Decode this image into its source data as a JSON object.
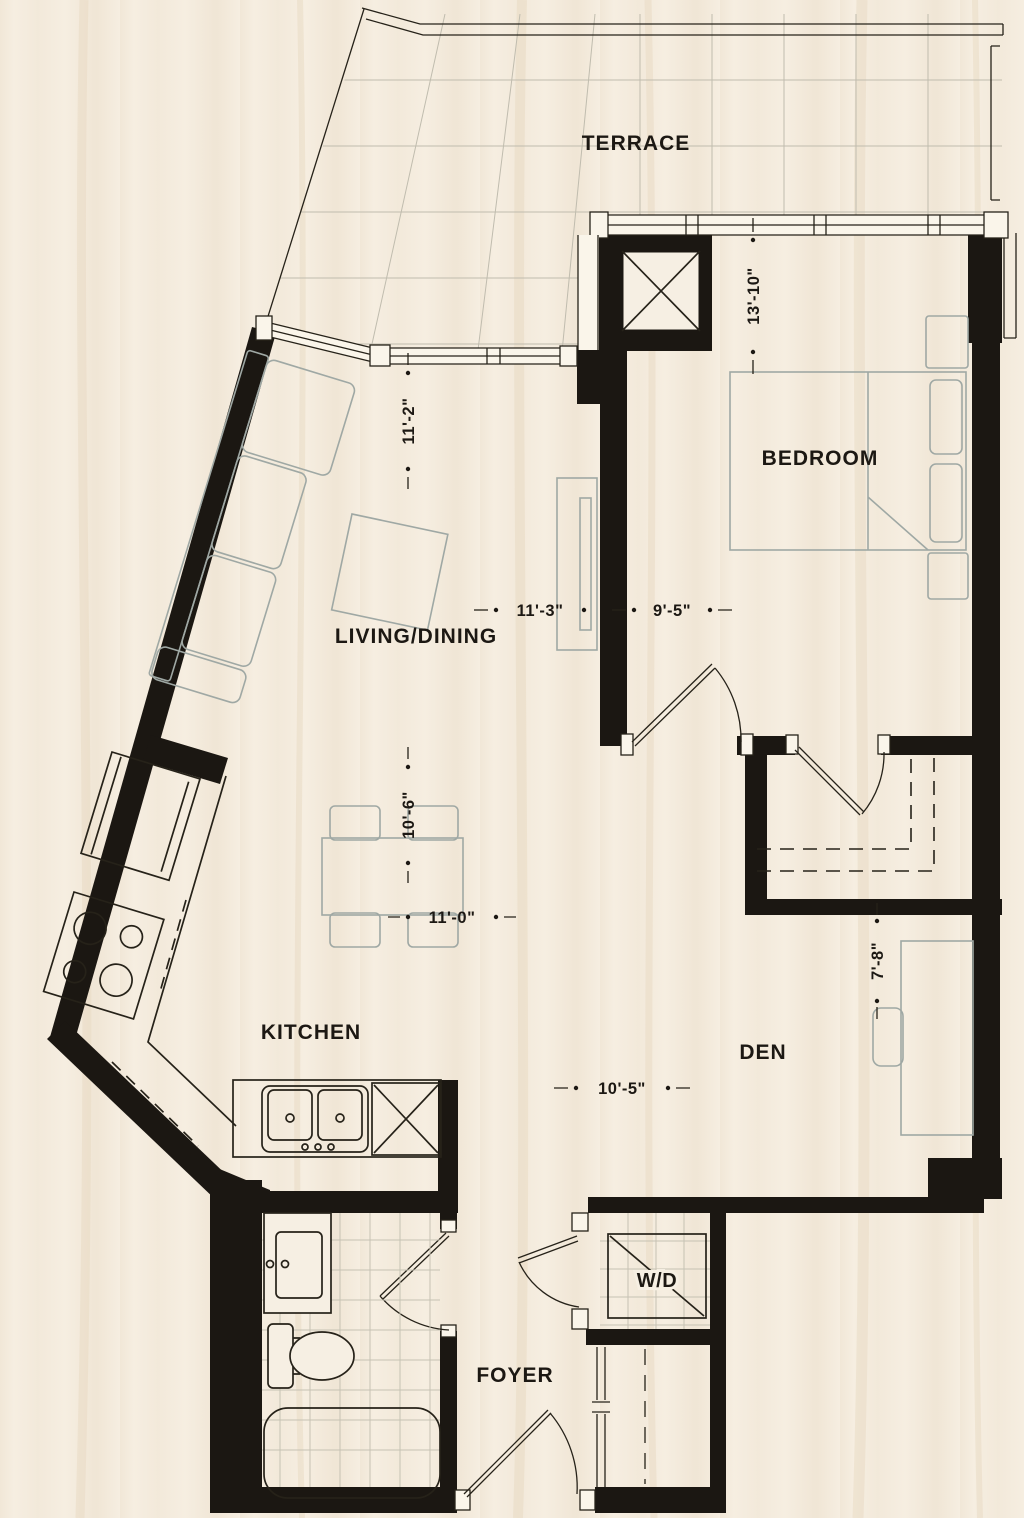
{
  "plan": {
    "type": "residential-floor-plan",
    "rooms": [
      {
        "id": "terrace",
        "label": "TERRACE"
      },
      {
        "id": "bedroom",
        "label": "BEDROOM"
      },
      {
        "id": "living-dining",
        "label": "LIVING/DINING"
      },
      {
        "id": "kitchen",
        "label": "KITCHEN"
      },
      {
        "id": "den",
        "label": "DEN"
      },
      {
        "id": "foyer",
        "label": "FOYER"
      },
      {
        "id": "washer-dryer",
        "label": "W/D"
      }
    ],
    "dimensions": [
      {
        "id": "bedroom-depth",
        "text": "13'-10\"",
        "orientation": "vertical"
      },
      {
        "id": "living-depth",
        "text": "11'-2\"",
        "orientation": "vertical"
      },
      {
        "id": "living-width",
        "text": "11'-3\"",
        "orientation": "horizontal"
      },
      {
        "id": "bedroom-width",
        "text": "9'-5\"",
        "orientation": "horizontal"
      },
      {
        "id": "dining-depth",
        "text": "10'-6\"",
        "orientation": "vertical"
      },
      {
        "id": "dining-width",
        "text": "11'-0\"",
        "orientation": "horizontal"
      },
      {
        "id": "den-depth",
        "text": "7'-8\"",
        "orientation": "vertical"
      },
      {
        "id": "den-width",
        "text": "10'-5\"",
        "orientation": "horizontal"
      }
    ],
    "fixtures": [
      "sectional-sofa",
      "coffee-table",
      "tv-console",
      "dining-table",
      "bed",
      "nightstands",
      "fridge",
      "stove",
      "double-sink",
      "dishwasher",
      "vanity-sink",
      "toilet",
      "bathtub",
      "stacked-washer-dryer",
      "desk",
      "desk-chair",
      "walk-in-closet-rods",
      "coat-closet-rod",
      "elevator-shaft"
    ],
    "colors": {
      "background": "#f6eee1",
      "wall": "#1b1712",
      "line": "#262219",
      "furniture": "#9fa8a4",
      "terrace_grid": "#c0bcae",
      "text": "#1c1813"
    }
  }
}
